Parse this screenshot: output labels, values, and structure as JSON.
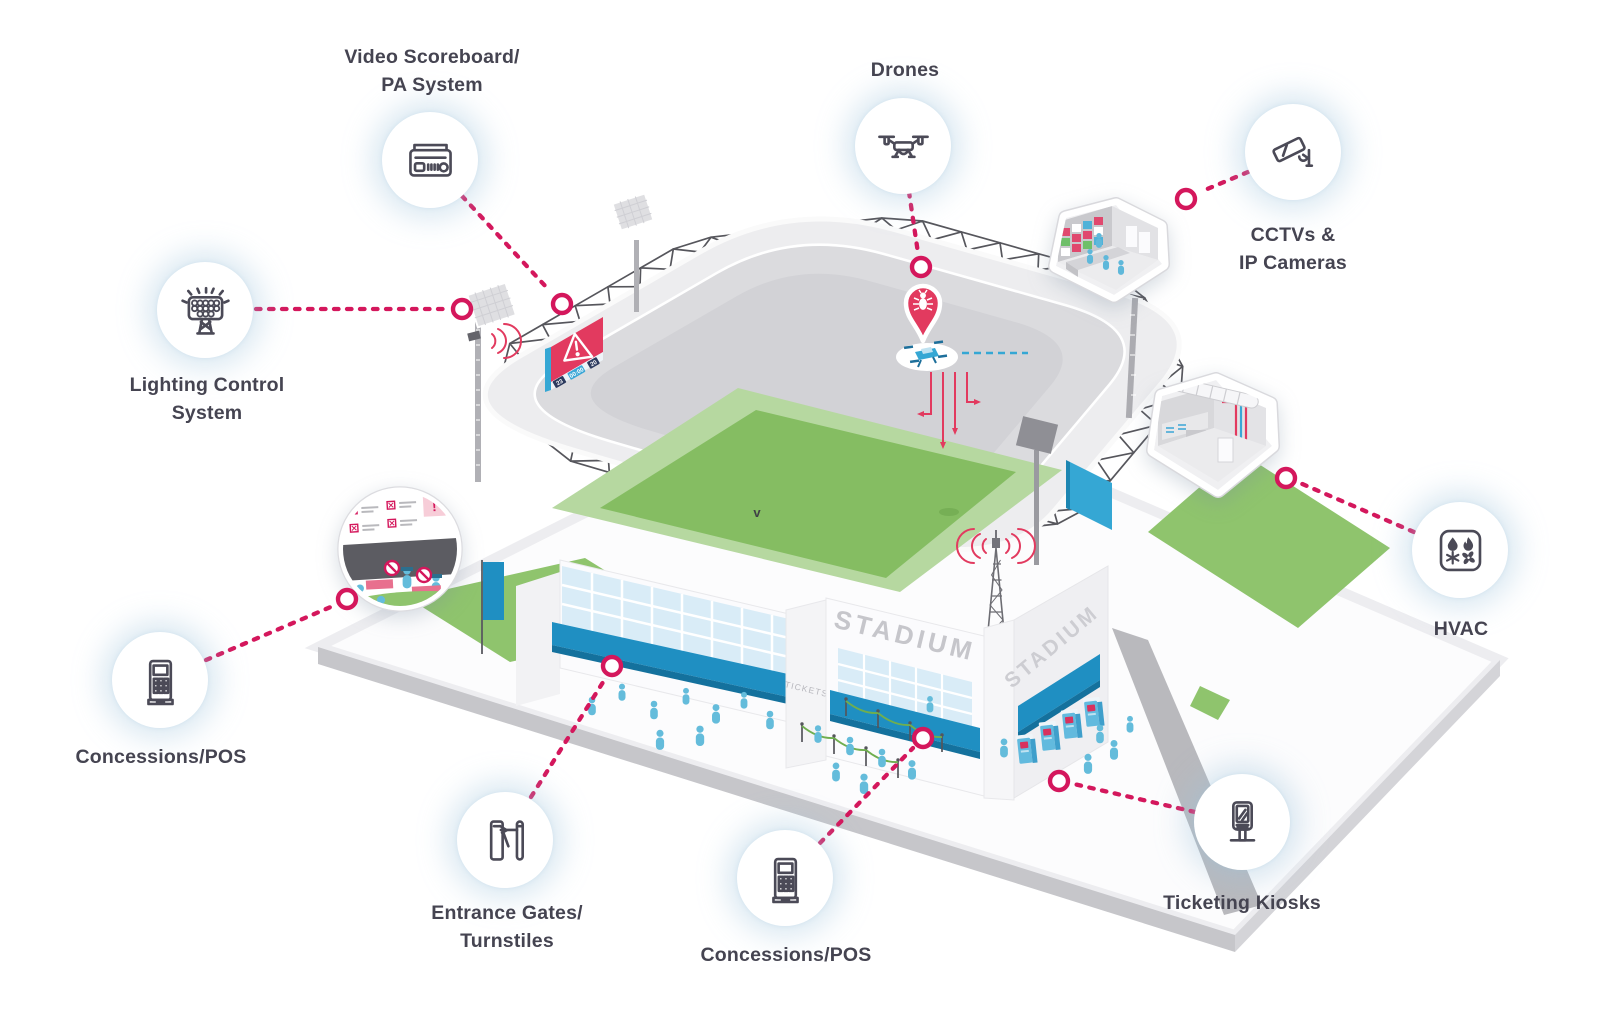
{
  "palette": {
    "accent_pink": "#d4175c",
    "accent_blue": "#1f8fc2",
    "field_green": "#85bd62",
    "field_green_light": "#b6d8a0",
    "roof_gray": "#ededef",
    "bowl_gray": "#dbdbde",
    "label_text": "#454451"
  },
  "callouts": {
    "video_scoreboard": {
      "label": "Video Scoreboard/\nPA System",
      "icon": "scoreboard-speaker-icon"
    },
    "drones": {
      "label": "Drones",
      "icon": "drone-icon"
    },
    "cctv": {
      "label": "CCTVs &\nIP Cameras",
      "icon": "cctv-camera-icon"
    },
    "lighting": {
      "label": "Lighting Control\nSystem",
      "icon": "floodlight-icon"
    },
    "hvac": {
      "label": "HVAC",
      "icon": "hvac-icon"
    },
    "concessions_left": {
      "label": "Concessions/POS",
      "icon": "pos-terminal-icon"
    },
    "entrance_gates": {
      "label": "Entrance Gates/\nTurnstiles",
      "icon": "turnstile-icon"
    },
    "concessions_bottom": {
      "label": "Concessions/POS",
      "icon": "pos-terminal-icon"
    },
    "ticketing": {
      "label": "Ticketing Kiosks",
      "icon": "ticket-kiosk-icon"
    }
  },
  "stadium": {
    "sign_front": "STADIUM",
    "sign_side": "STADIUM",
    "tickets_sign": "TICKETS",
    "field_mark": "v",
    "warning_mark": "!",
    "scoreboard": {
      "left_score": "23",
      "clock": "00:00",
      "right_score": "20"
    }
  }
}
